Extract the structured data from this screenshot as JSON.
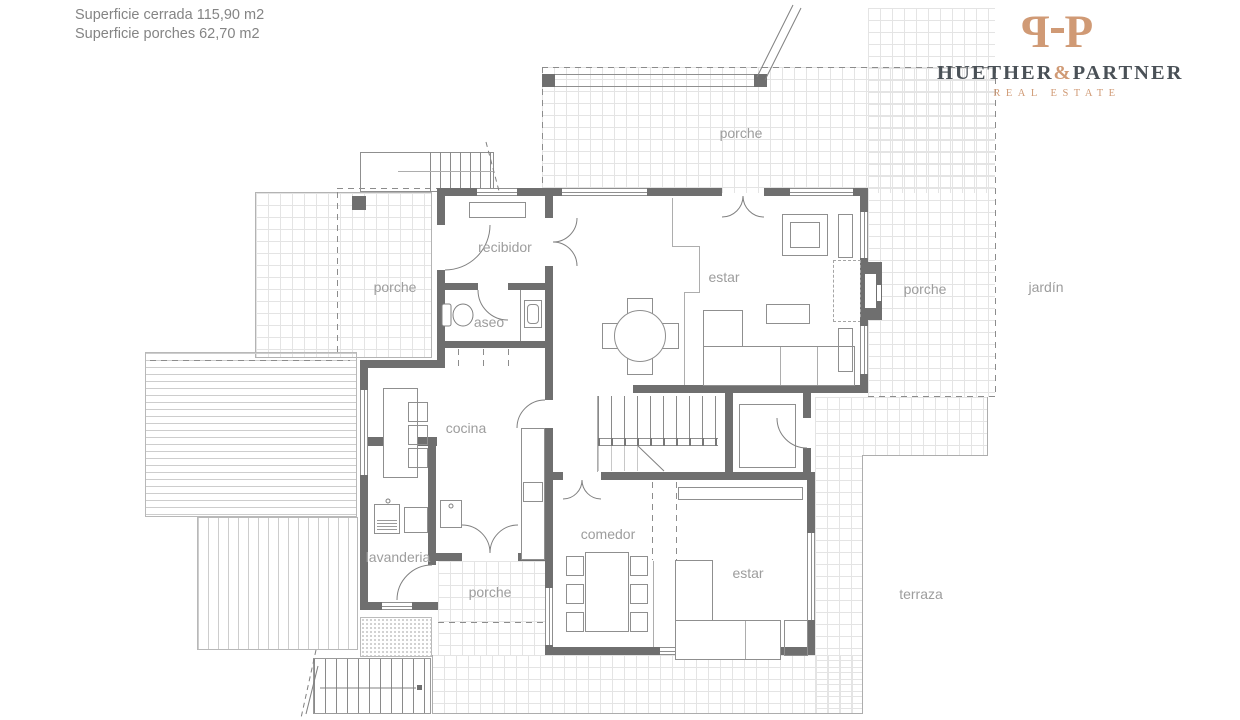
{
  "header": {
    "line1": "Superficie cerrada 115,90 m2",
    "line2": "Superficie  porches 62,70 m2"
  },
  "logo": {
    "monogram_left": "P",
    "monogram_right": "P",
    "brand_main": "HUETHER",
    "brand_amp": "&",
    "brand_sub": "PARTNER",
    "tagline": "REAL ESTATE"
  },
  "rooms": {
    "porche": "porche",
    "recibidor": "recibidor",
    "aseo": "aseo",
    "estar": "estar",
    "cocina": "cocina",
    "lavanderia": "lavanderia",
    "comedor": "comedor",
    "jardin": "jardín",
    "terraza": "terraza"
  },
  "colors": {
    "wall": "#6f6f6f",
    "grid_line": "#e4e4e4",
    "label_text": "#9d9d9d",
    "logo_copper": "#d09a75",
    "logo_dark": "#4a5157"
  }
}
